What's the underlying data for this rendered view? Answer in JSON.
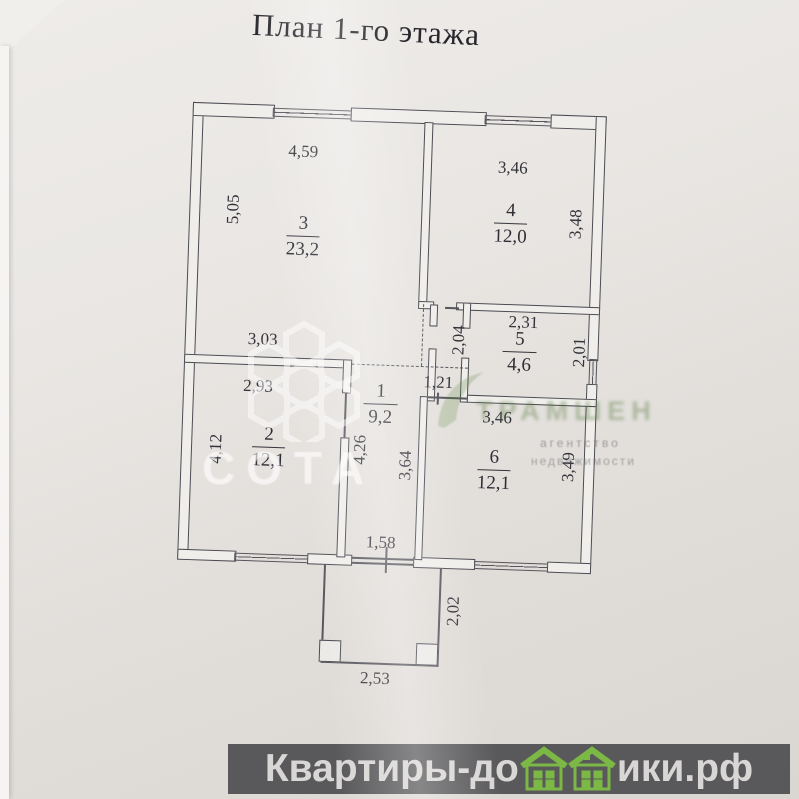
{
  "title": "План 1-го этажа",
  "rooms": {
    "r1": {
      "number": "1",
      "area": "9,2"
    },
    "r2": {
      "number": "2",
      "area": "12,1"
    },
    "r3": {
      "number": "3",
      "area": "23,2"
    },
    "r4": {
      "number": "4",
      "area": "12,0"
    },
    "r5": {
      "number": "5",
      "area": "4,6"
    },
    "r6": {
      "number": "6",
      "area": "12,1"
    }
  },
  "dims": {
    "top_left": "4,59",
    "top_right": "3,46",
    "left_upper": "5,05",
    "right_upper": "3,48",
    "room5_top": "2,31",
    "corridor_h": "2,04",
    "room5_right": "2,01",
    "room2_above": "3,03",
    "room2_top": "2,93",
    "passage": "1,21",
    "room6_top": "3,46",
    "room2_left": "4,12",
    "hall_left": "4,26",
    "hall_right": "3,64",
    "room6_right": "3,49",
    "entrance": "1,58",
    "porch_right": "2,02",
    "porch_bottom": "2,53"
  },
  "watermarks": {
    "sota": "СОТА",
    "agency": "ТРАМШЕН",
    "agency_sub1": "агентство",
    "agency_sub2": "недвижимости"
  },
  "footer": {
    "site_left": "Квартиры-до",
    "site_right": "ики.рф",
    "bar_color": "#59595b",
    "house_green": "#7cb845"
  }
}
